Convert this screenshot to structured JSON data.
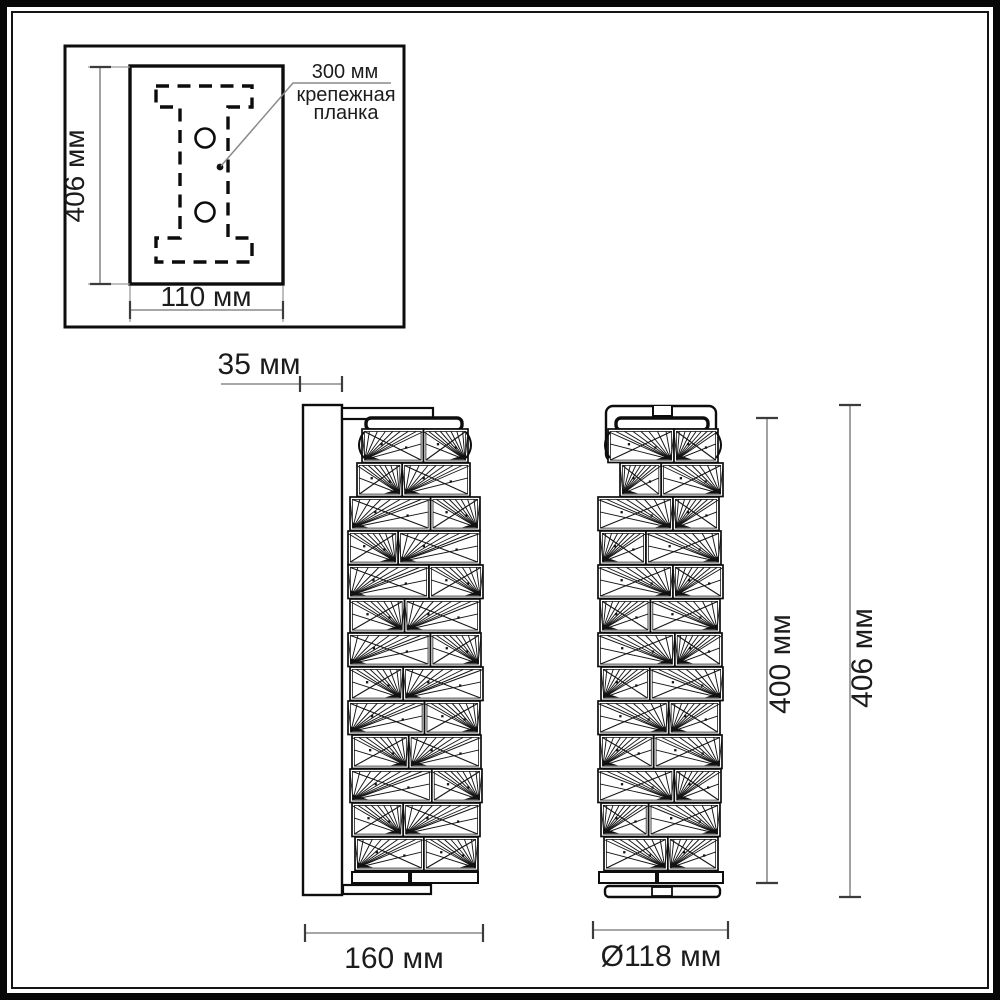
{
  "inset": {
    "height_label": "406 мм",
    "width_label": "110 мм",
    "callout_dim": "300 мм",
    "callout_name": [
      "крепежная",
      "планка"
    ]
  },
  "side_view": {
    "depth_label": "35 мм",
    "width_label": "160 мм"
  },
  "front_view": {
    "diameter_label": "Ø118 мм",
    "inner_height_label": "400 мм",
    "total_height_label": "406 мм"
  },
  "colors": {
    "drawing_line": "#0d0d0d",
    "dimension_line": "#8a8a8a",
    "text": "#1c1c1c",
    "background": "#ffffff"
  }
}
